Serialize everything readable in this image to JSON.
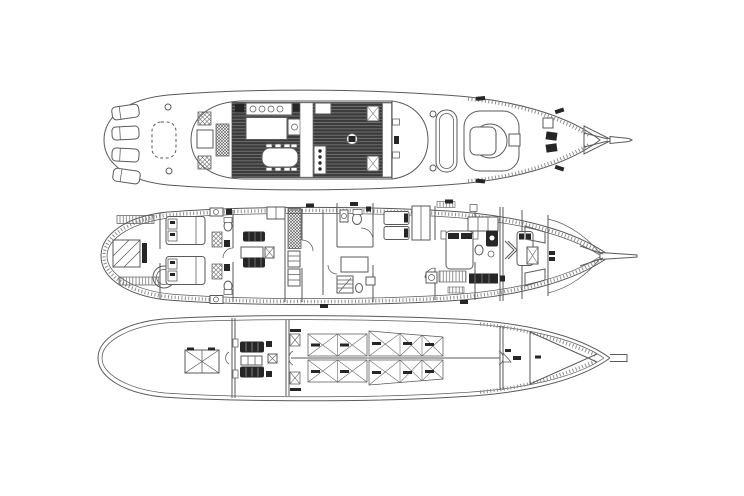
{
  "drawing": {
    "title": "yacht-deck-plans",
    "type": "technical-line-drawing",
    "decks_count": 3,
    "orientation": "bow-right",
    "visible_text": ""
  },
  "colors": {
    "line": "#5a5a5a",
    "line_light": "#8f8f8f",
    "dark_fill": "#262626",
    "paper": "#ffffff",
    "floor_dark": "#3a3a3a",
    "floor_line": "#7d7d7d"
  },
  "decks": [
    {
      "id": "sun-deck",
      "position": "top",
      "features": [
        "sun-loungers",
        "aft-folding-table",
        "deck-saloon-planked-floor",
        "galley-counters",
        "galley-island",
        "dining-table-with-chairs",
        "companionway",
        "pilothouse-front",
        "foredeck-skylight",
        "tender-pod",
        "anchor-windlass",
        "bowsprit-truss",
        "deck-cleats"
      ]
    },
    {
      "id": "main-deck",
      "position": "middle",
      "features": [
        "aft-lounge",
        "round-table",
        "double-cabin-aft-1",
        "double-cabin-aft-2",
        "ensuite-bathrooms",
        "lobby-sofas-and-table",
        "staircase",
        "twin-cabin",
        "wardrobe",
        "master-cabin",
        "master-bathroom",
        "guest-cabin",
        "crew-bunks",
        "bulwark-hatching",
        "bowsprit"
      ]
    },
    {
      "id": "lower-deck",
      "position": "bottom",
      "features": [
        "stern-tank",
        "engine-room",
        "port-engine",
        "starboard-engine",
        "gearbox",
        "fuel-and-water-tanks",
        "tank-label-marks",
        "keel-centerline",
        "forepeak-bracing",
        "bow-stub"
      ]
    }
  ]
}
